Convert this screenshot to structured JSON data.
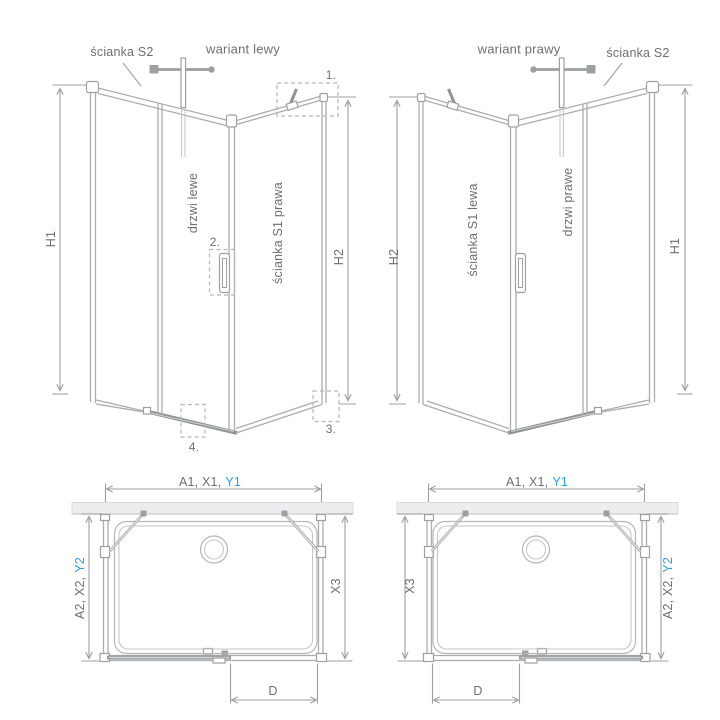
{
  "colors": {
    "accent_blue": "#2ba0d8",
    "line_gray": "#a9adb0",
    "line_dark": "#8f9396",
    "text_gray": "#6b7075",
    "wall_fill": "#ecedee"
  },
  "left_variant": {
    "title": "wariant lewy",
    "wall_s2": "ścianka S2",
    "door": "drzwi lewe",
    "wall_s1": "ścianka S1 prawa",
    "dim_left": "H1",
    "dim_right": "H2",
    "callout_1": "1.",
    "callout_2": "2.",
    "callout_3": "3.",
    "callout_4": "4."
  },
  "right_variant": {
    "title": "wariant prawy",
    "wall_s2": "ścianka S2",
    "door": "drzwi prawe",
    "wall_s1": "ścianka S1 lewa",
    "dim_left": "H2",
    "dim_right": "H1"
  },
  "left_plan": {
    "dim_width": "A1, X1,",
    "dim_width_accent": "Y1",
    "dim_depth": "A2, X2,",
    "dim_depth_accent": "Y2",
    "dim_side": "X3",
    "dim_door": "D"
  },
  "right_plan": {
    "dim_width": "A1, X1,",
    "dim_width_accent": "Y1",
    "dim_depth": "A2, X2,",
    "dim_depth_accent": "Y2",
    "dim_side": "X3",
    "dim_door": "D"
  }
}
